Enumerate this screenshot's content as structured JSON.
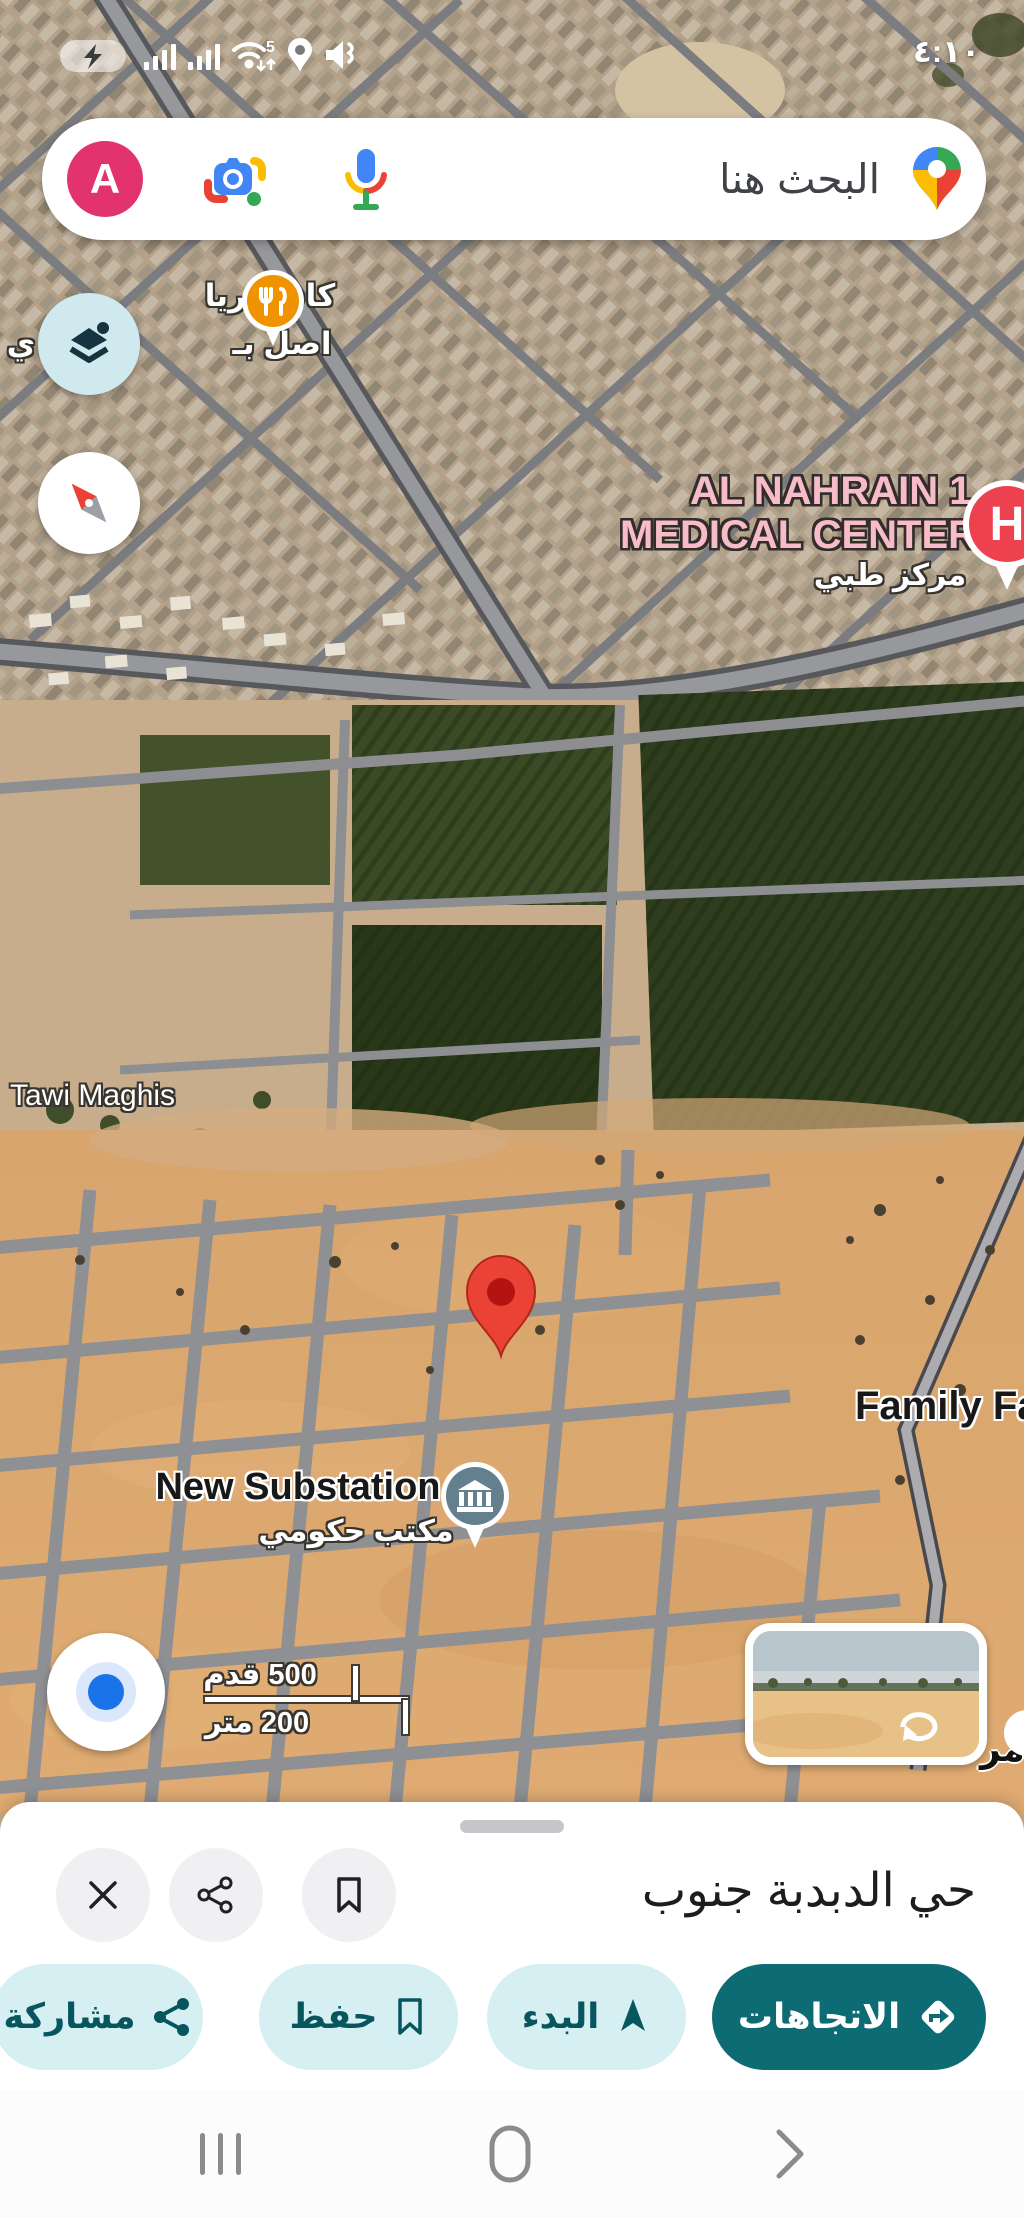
{
  "status_bar": {
    "time": "٤:١٠"
  },
  "search": {
    "placeholder": "البحث هنا",
    "avatar_letter": "A"
  },
  "map": {
    "poi_cafeteria_line1": "كافيتيريا",
    "poi_cafeteria_line2": "اصل بـ",
    "poi_cafeteria_line2_tail": "ي",
    "medical_line1": "AL NAHRAIN 1",
    "medical_line2": "MEDICAL CENTER...",
    "medical_sub": "مركز طبي",
    "hospital_letter": "H",
    "tawi_maghis": "Tawi Maghis",
    "family_farm": "Family Farm",
    "new_substation": "New Substation",
    "gov_office": "مكتب حكومي",
    "partial_label": "مر",
    "scale_feet": "500 قدم",
    "scale_meters": "200 متر"
  },
  "sheet": {
    "title": "حي الدبدبة جنوب",
    "directions": "الاتجاهات",
    "start": "البدء",
    "save": "حفظ",
    "share": "مشاركة"
  },
  "colors": {
    "accent_teal": "#0d6b73",
    "accent_teal_light": "#d6eff3",
    "accent_teal_text": "#07565e",
    "avatar_pink": "#e2336e",
    "destination_pin_red": "#ea4335",
    "hospital_red": "#ee4150",
    "medical_label_pink": "#f7bcc8",
    "restaurant_orange": "#f09300"
  }
}
